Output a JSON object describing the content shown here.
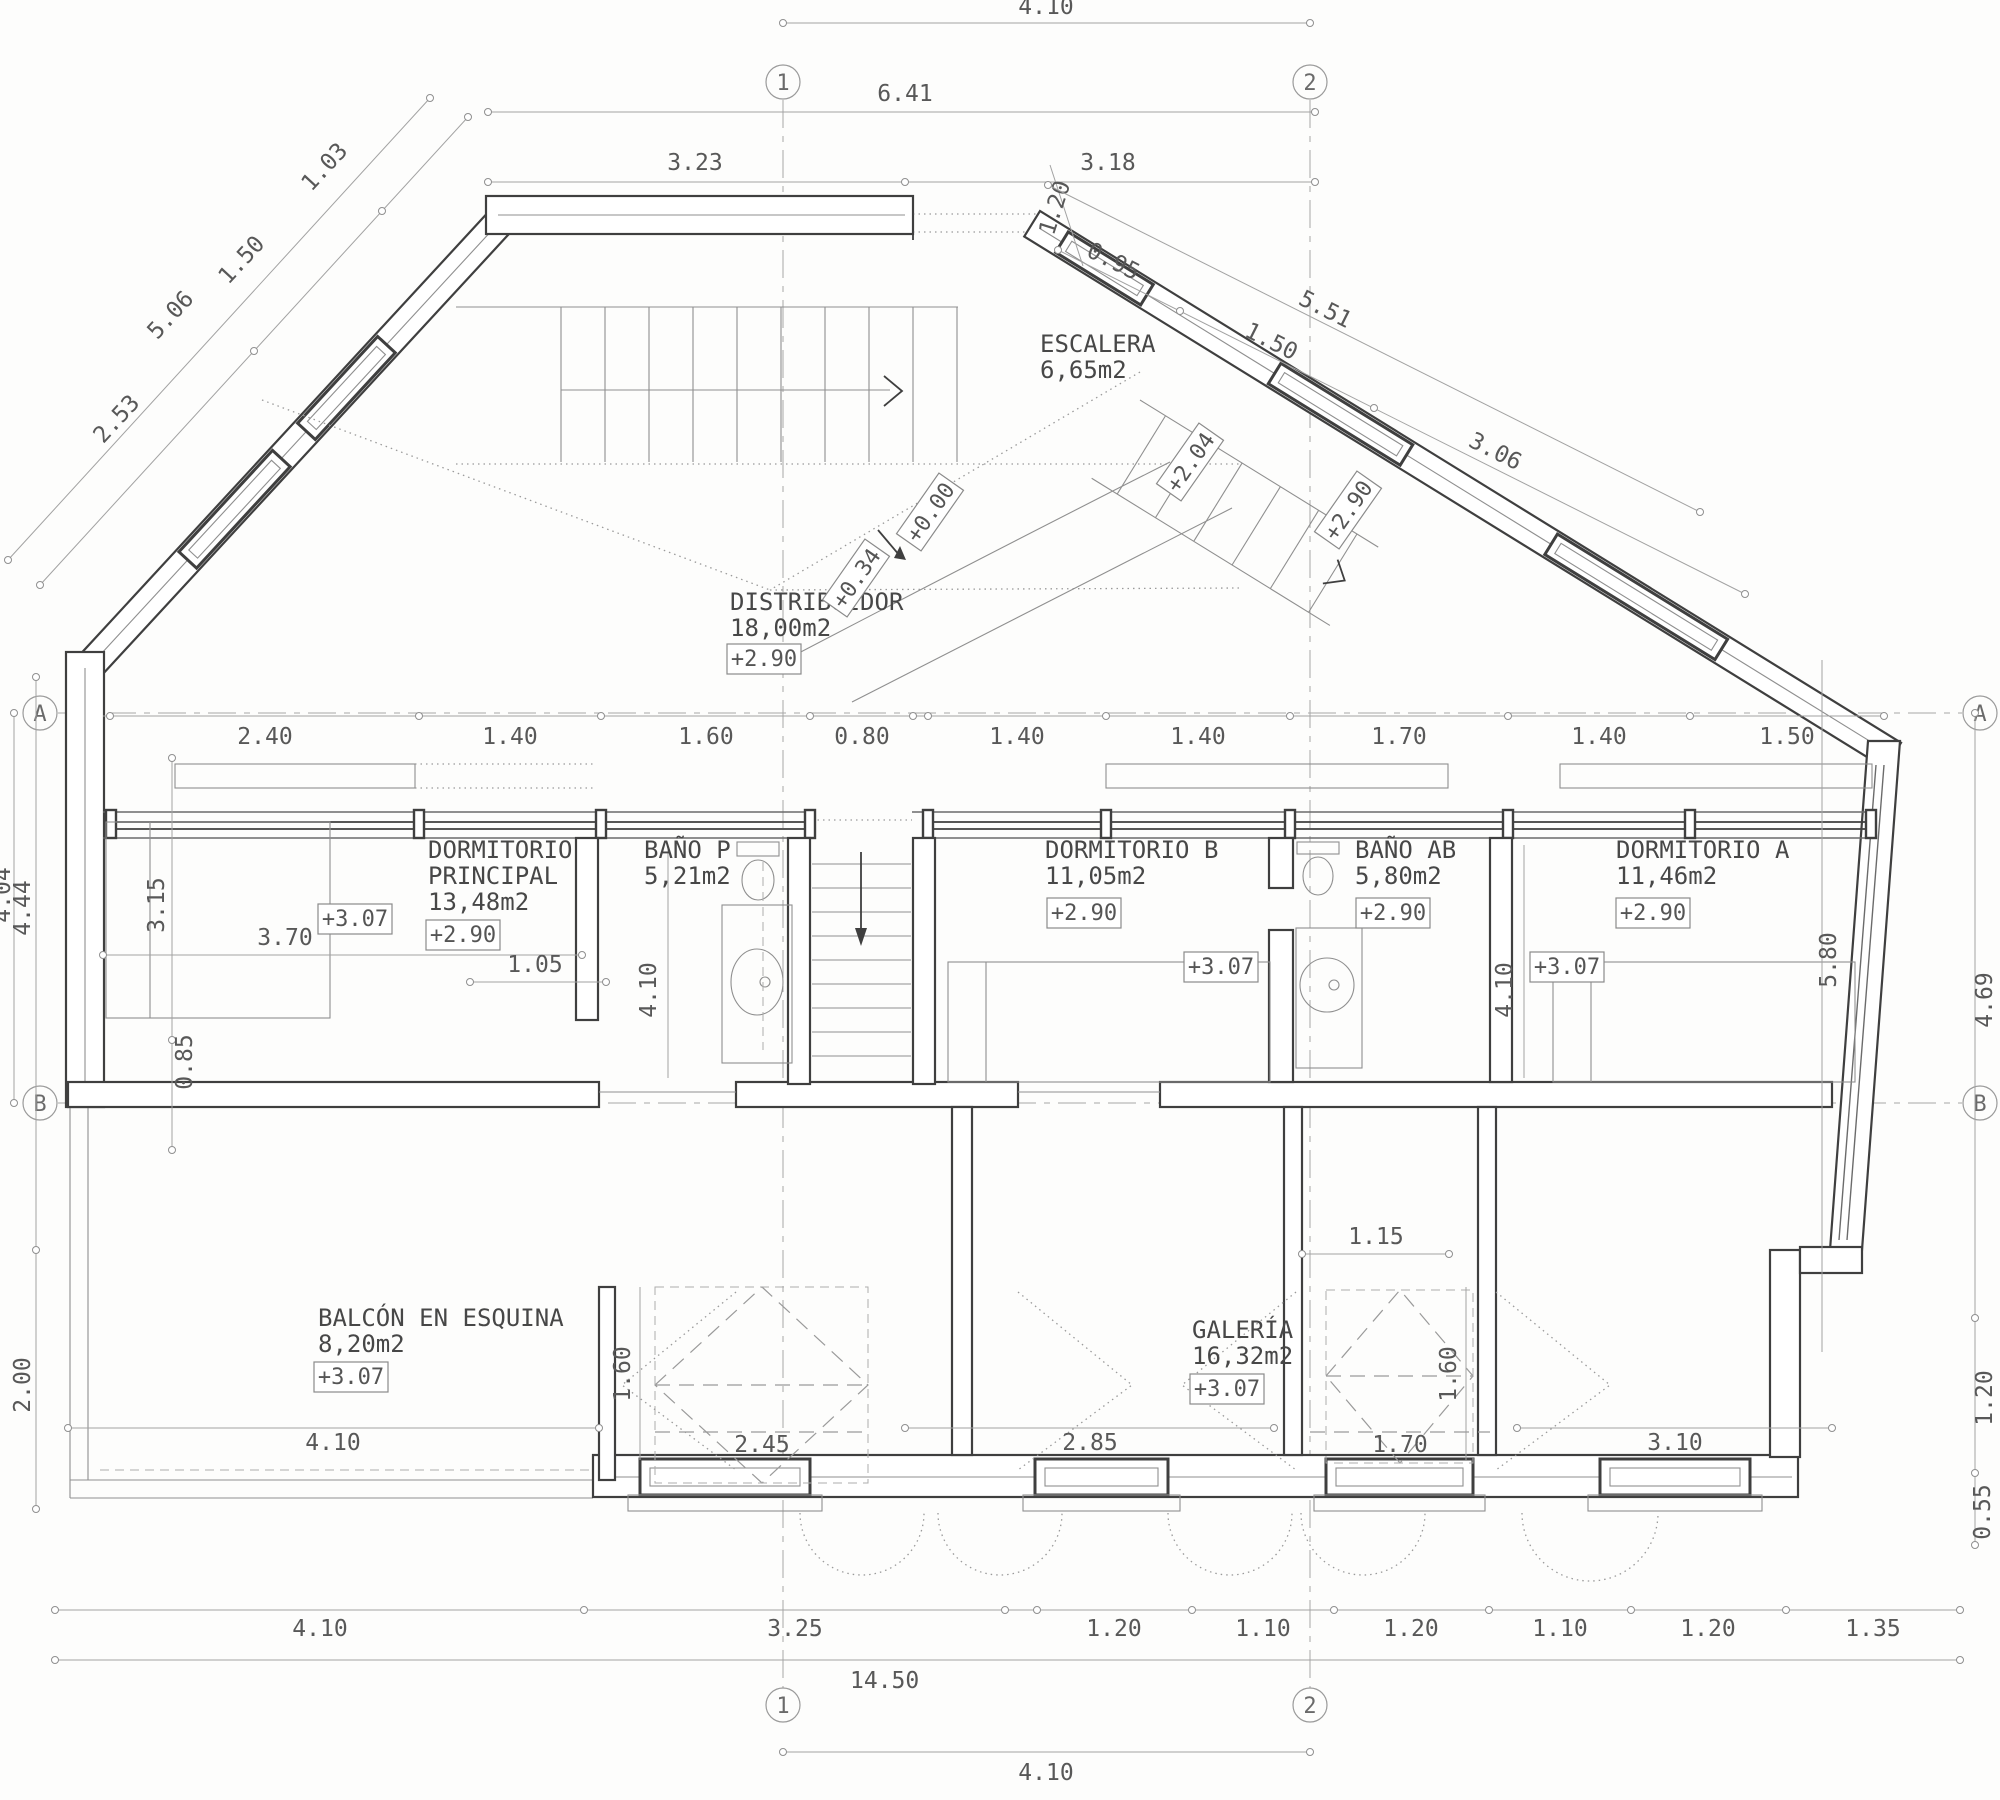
{
  "grid": {
    "col1": "1",
    "col2": "2",
    "rowA": "A",
    "rowB": "B"
  },
  "rooms": {
    "escalera": {
      "name": "ESCALERA",
      "area": "6,65m2"
    },
    "distribuidor": {
      "name": "DISTRIBUIDOR",
      "area": "18,00m2",
      "level": "+2.90"
    },
    "dormitorio_principal": {
      "name_line1": "DORMITORIO",
      "name_line2": "PRINCIPAL",
      "area": "13,48m2",
      "level": "+2.90",
      "floor_level": "+3.07"
    },
    "bano_p": {
      "name": "BAÑO P",
      "area": "5,21m2"
    },
    "dormitorio_b": {
      "name": "DORMITORIO B",
      "area": "11,05m2",
      "level": "+2.90",
      "floor_level": "+3.07"
    },
    "bano_ab": {
      "name": "BAÑO AB",
      "area": "5,80m2",
      "level": "+2.90"
    },
    "dormitorio_a": {
      "name": "DORMITORIO A",
      "area": "11,46m2",
      "level": "+2.90",
      "floor_level": "+3.07"
    },
    "balcon": {
      "name": "BALCÓN EN ESQUINA",
      "area": "8,20m2",
      "level": "+3.07"
    },
    "galeria": {
      "name": "GALERÍA",
      "area": "16,32m2",
      "level": "+3.07"
    }
  },
  "levels": {
    "entry": "+0.00",
    "step": "+0.34",
    "mid": "+2.04",
    "upper": "+2.90"
  },
  "dims": {
    "top": {
      "total": "4.10",
      "upper": "6.41",
      "left": "3.23",
      "right": "3.18"
    },
    "diag_left": {
      "total": "5.06",
      "seg1": "2.53",
      "seg2": "1.50",
      "seg3": "1.03"
    },
    "diag_right": {
      "corner": "1.20",
      "total": "5.51",
      "seg1": "0.95",
      "seg2": "1.50",
      "seg3": "3.06"
    },
    "row_a": [
      "2.40",
      "1.40",
      "1.60",
      "0.80",
      "1.40",
      "1.40",
      "1.70",
      "1.40",
      "1.50"
    ],
    "left": {
      "a_b": "4.04",
      "outer": "4.44",
      "room": "3.15",
      "lower": "0.85",
      "balcony": "2.00",
      "bed": "3.70",
      "inner": "1.05"
    },
    "mid": {
      "bano_p": "4.10",
      "dorm_a": "4.10",
      "galeria": "1.15",
      "dorm_a_depth": "5.80"
    },
    "right": {
      "upper": "4.69",
      "lower": "1.20",
      "step": "0.55"
    },
    "galeria_heights": {
      "balcon": "1.60",
      "galeria": "1.60"
    },
    "row_interior": [
      "4.10",
      "2.45",
      "2.85",
      "1.70",
      "3.10"
    ],
    "row_bottom": [
      "4.10",
      "3.25",
      "1.20",
      "1.10",
      "1.20",
      "1.10",
      "1.20",
      "1.35"
    ],
    "total_width": "14.50",
    "bottom_grid": "4.10"
  }
}
